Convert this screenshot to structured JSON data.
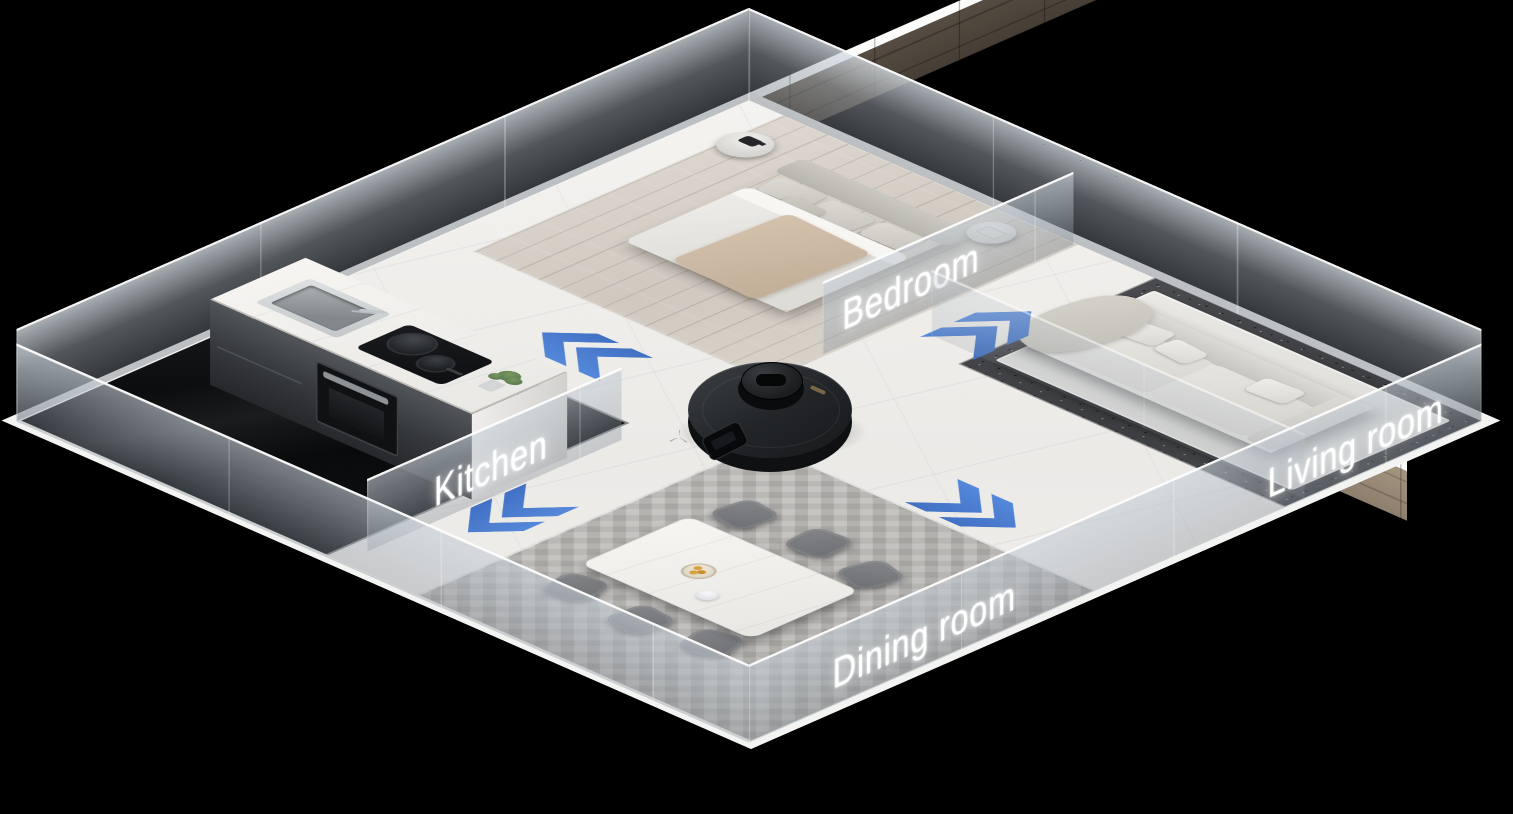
{
  "rooms": [
    {
      "id": "bedroom",
      "label": "Bedroom"
    },
    {
      "id": "kitchen",
      "label": "Kitchen"
    },
    {
      "id": "living-room",
      "label": "Living room"
    },
    {
      "id": "dining-room",
      "label": "Dining room"
    }
  ],
  "robot": {
    "icon": "robot-vacuum-icon",
    "body_color": "#26282B"
  },
  "arrows": {
    "color": "#4E80D4",
    "groups": [
      {
        "id": "toward-kitchen",
        "direction": "up-left",
        "chevrons": 2
      },
      {
        "id": "toward-living-room",
        "direction": "up-right",
        "chevrons": 2
      },
      {
        "id": "toward-bottom-left",
        "direction": "down-left",
        "chevrons": 2
      },
      {
        "id": "toward-dining-room",
        "direction": "down-right",
        "chevrons": 2
      }
    ]
  },
  "palette": {
    "background": "#000000",
    "arrow_blue": "#4E80D4",
    "marble_floor": "#F1F0ED",
    "glass_wall": "#9AA4AC",
    "wood_plinth_light": "#9B8C7B",
    "wood_plinth_dark": "#4A423A",
    "label_text": "#FFFFFF"
  }
}
